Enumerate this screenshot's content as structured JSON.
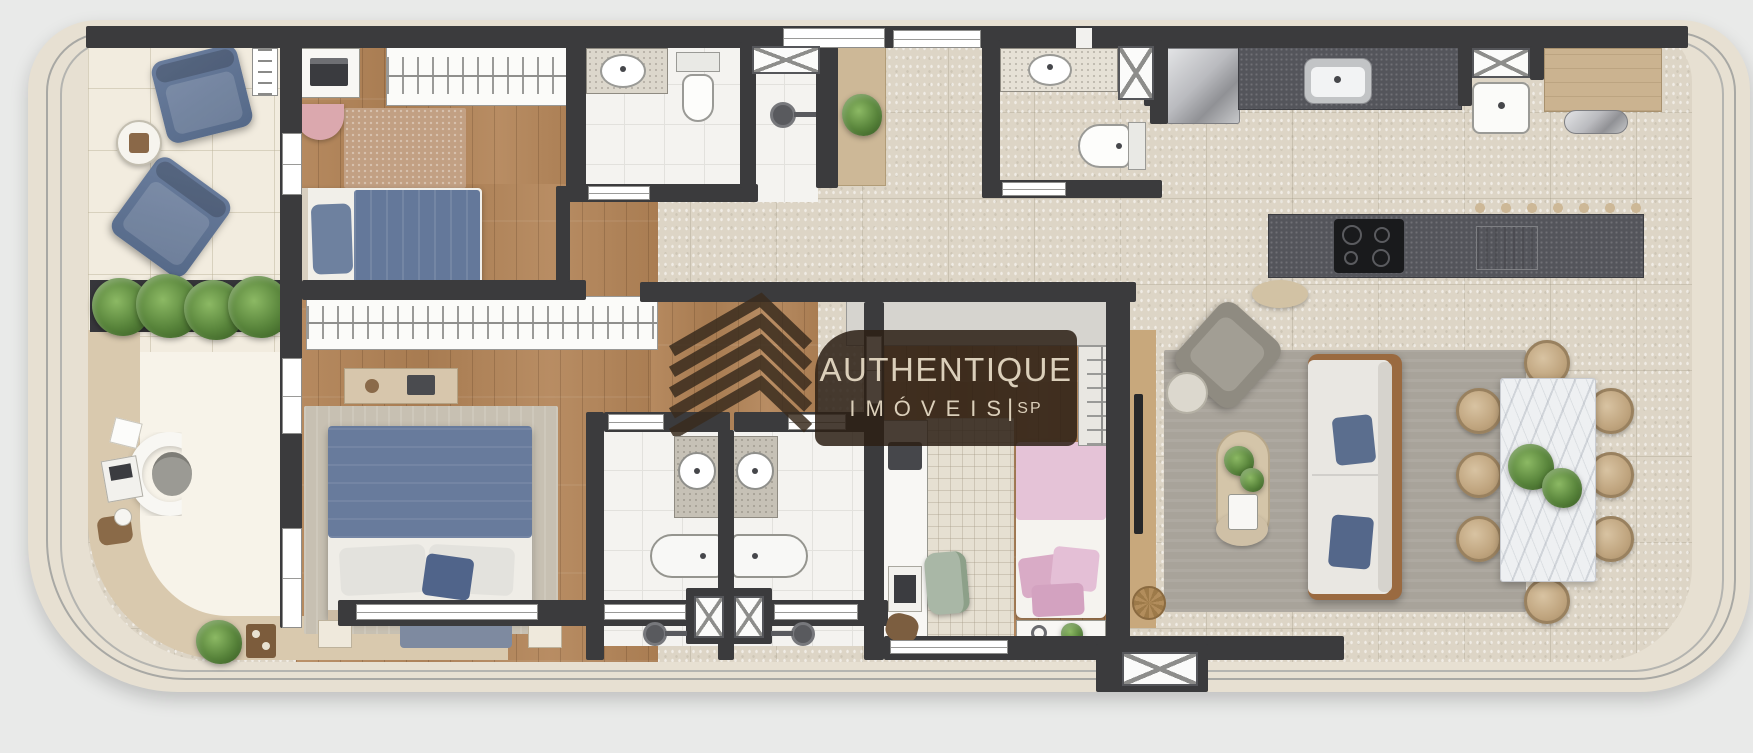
{
  "watermark": {
    "brand": "AUTHENTIQUE",
    "line2": "IMÓVEIS",
    "separator": "|",
    "region": "SP"
  },
  "palette": {
    "bg": "#e9eae9",
    "facade": "#e7e0d2",
    "deck": "#d9c9ae",
    "wall": "#3b3b3d",
    "wood": "#b28356",
    "stone": "#ddd5c6",
    "tileWhite": "#f4f3f0",
    "terrace": "#f2ecdf",
    "blue": "#64789a",
    "pink": "#e5c3d7",
    "green": "#57833a",
    "rugGray": "#a8a39a",
    "counterDark": "#54555b",
    "logoBg": "rgba(44,31,21,0.86)",
    "logoText": "#dbcfba"
  }
}
